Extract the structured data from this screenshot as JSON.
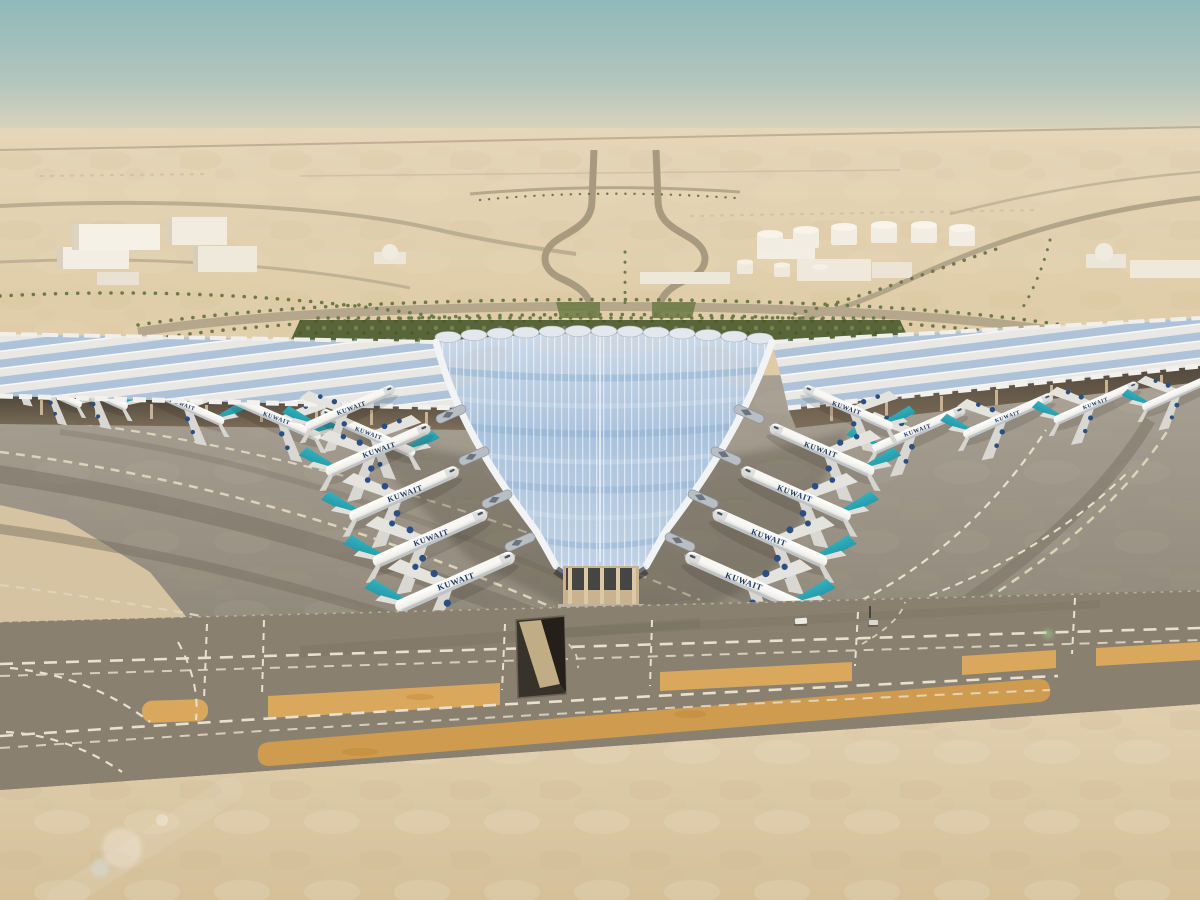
{
  "scene": {
    "description": "Aerial architectural rendering of Kuwait International Airport new trefoil passenger terminal",
    "setting": "desert airfield under a hazy teal daytime sky"
  },
  "aircraft": {
    "livery_label": "KUWAIT",
    "total_visible": 20,
    "groups": {
      "left_concourse_row": 4,
      "left_v_row": 5,
      "right_v_row": 5,
      "right_concourse_row": 4,
      "far_left_partial": 2
    },
    "colors": {
      "fuselage_white": "#f2f1ec",
      "tail_teal_light": "#4cc6cb",
      "tail_teal_dark": "#157a9b",
      "engine_navy": "#2a4f80",
      "title_navy": "#1c3a66"
    }
  },
  "terminal": {
    "roof_style": "trefoil cascading canopy with photovoltaic ribbed glass",
    "colors": {
      "roof_glass_blue": "#b7cde4",
      "roof_rib_white": "#eef1f5",
      "concourse_canopy_white": "#e9e8e4",
      "solar_strip_blue": "#a3bcd7",
      "column_tan": "#c9b28d"
    }
  },
  "airfield": {
    "apron_gray": "#a09889",
    "taxiway_gray": "#8a8070",
    "marking_cream": "#e9e1cd",
    "sand_island_orange": "#d9a85c",
    "foreground_sand": "#ddc9a7",
    "service_tunnel_dark": "#37332b",
    "service_vehicles": 2
  },
  "background": {
    "sky_top": "#8fb9ba",
    "horizon_haze": "#ded5bd",
    "desert_sand": "#dfc9a3",
    "buildings": "white warehouses with two domed halls",
    "fuel_tanks": 9,
    "vegetation": "palm-lined boulevards and green gardens behind the terminal",
    "green_hedge": "#5c683a"
  }
}
